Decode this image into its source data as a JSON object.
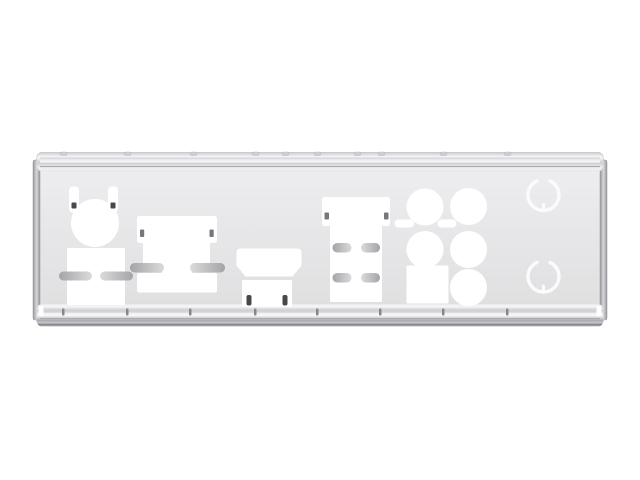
{
  "scene": {
    "description": "Product photograph of a silver stainless-steel motherboard rear I/O shield backplate, shown straight on against a plain white background",
    "object": "io-shield-backplate",
    "orientation": "horizontal"
  },
  "colors": {
    "background": "#ffffff",
    "plate_face": "#e7e7e9",
    "plate_face_light": "#efeff1",
    "plate_face_dark": "#dededf",
    "rim_highlight": "#f8f8fa",
    "rim_mid": "#cfcfd3",
    "rim_shadow": "#aaaaae",
    "rim_dark": "#8a8a8e",
    "flange_light": "#d8d8dc",
    "flange_dark": "#96969a",
    "outline": "#b2b2b6",
    "cutout_white": "#ffffff",
    "slot_dark": "#a4a4a8",
    "slot_light": "#dbdbdd",
    "screw_dark": "#48484c",
    "screw_medium": "#77777b",
    "notch_dark": "#86868a",
    "knockout_ring": "#fbfbfd"
  },
  "cutouts": [
    {
      "id": "ps2-port",
      "label": "Round PS/2 port cutout with two screw tabs"
    },
    {
      "id": "usb-stack",
      "label": "Dual stacked USB port cutout with side divider slots"
    },
    {
      "id": "vga-port",
      "label": "Wide VGA-style cutout with screw tabs and divider slots"
    },
    {
      "id": "hdmi-port",
      "label": "HDMI trapezoid cutout above a small rectangular cutout with two bent tabs"
    },
    {
      "id": "display-port-stack",
      "label": "Stacked display-output cutout with four divider slots and screw tabs"
    },
    {
      "id": "audio-jacks",
      "label": "Audio jack cluster: five round holes, one square hole, two small pill slots"
    },
    {
      "id": "knockouts",
      "label": "Two scored circular knockouts on the right end"
    }
  ],
  "counts": {
    "audio_round_holes": 5,
    "audio_square_holes": 1,
    "knockout_circles": 2,
    "top_rim_notches": 10,
    "bottom_rim_notches": 8
  }
}
